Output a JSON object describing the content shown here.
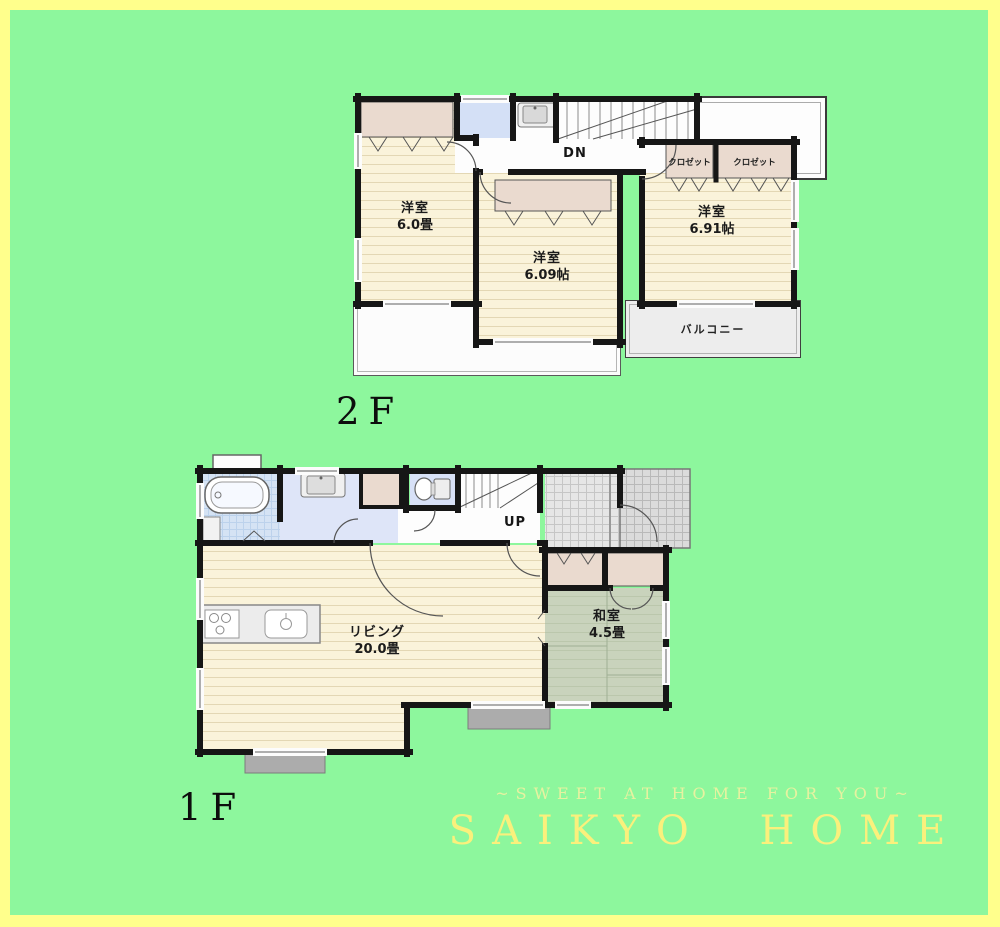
{
  "page": {
    "frame_color": "#FFFF8C",
    "background_color": "#8DF79D"
  },
  "plan2f": {
    "floor_label": "2F",
    "rooms": {
      "bedroom_west": {
        "name": "洋室",
        "size": "6.0畳"
      },
      "bedroom_center": {
        "name": "洋室",
        "size": "6.09帖"
      },
      "bedroom_east": {
        "name": "洋室",
        "size": "6.91帖"
      }
    },
    "closets": [
      "クロゼット",
      "クロゼット"
    ],
    "balcony_label": "バルコニー",
    "stairs_label": "DN"
  },
  "plan1f": {
    "floor_label": "1F",
    "rooms": {
      "living": {
        "name": "リビング",
        "size": "20.0畳"
      },
      "japanese_room": {
        "name": "和室",
        "size": "4.5畳"
      }
    },
    "stairs_label": "UP"
  },
  "footer": {
    "tagline": "~SWEET AT HOME FOR YOU~",
    "brand": "SAIKYO HOME"
  }
}
